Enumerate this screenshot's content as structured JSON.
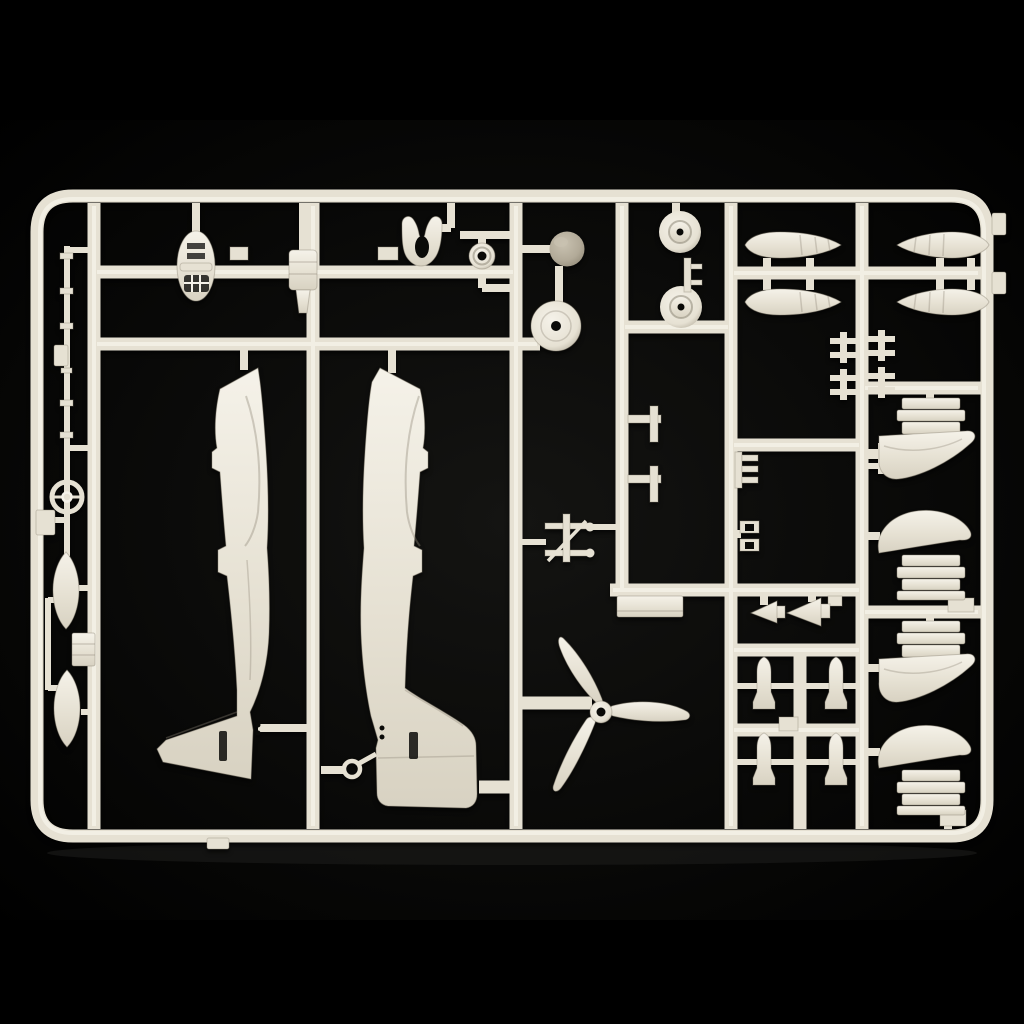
{
  "meta": {
    "type": "photograph",
    "subject": "plastic model aircraft kit sprue",
    "description": "Ivory injection-molded model kit parts tree (sprue) on a black background: two fuselage halves, three-blade propeller, four drop tank halves, wheels, spinner dome, engine cowling halves, small bombs, antenna mast and assorted small parts held in a rounded rectangular runner frame."
  },
  "scene": {
    "colors": {
      "background": "#000000",
      "vignette": "#141412",
      "plastic": "#e6e1d3",
      "plastic_light": "#f5f2e9",
      "plastic_mid": "#d8d2c2",
      "plastic_dark": "#b1aa99",
      "outline": "#8e8878",
      "spinner_light": "#c9c2b1",
      "spinner": "#b2aa98",
      "spinner_dark": "#8f8775",
      "hole": "#0a0a08",
      "shadow": "#1c1c1a"
    }
  },
  "parts": {
    "frame": "sprue outer frame",
    "runners": "runner grid",
    "antenna_mast": "antenna mast with ring sight",
    "left_edge_block": "small block on left frame edge",
    "small_bomb_upper": "small bomb half, upper left",
    "small_bomb_lower": "small bomb half, lower left",
    "left_block": "rectangular block part",
    "cowl_front": "cowling front piece with grille",
    "engine_block": "engine block part",
    "horseshoe": "horseshoe shaped part",
    "hub_ring": "ring hub part",
    "spinner_dome": "propeller spinner dome",
    "wheel_disc": "wheel disc",
    "fuselage_left": "left fuselage half",
    "fuselage_right": "right fuselage half",
    "tail_hook": "tail hook ring",
    "wheel_upper": "main wheel, upper",
    "wheel_lower": "main wheel, lower",
    "axle_part": "axle part between wheels",
    "drop_tank_1": "drop tank half, upper left",
    "drop_tank_2": "drop tank half, lower left",
    "drop_tank_3": "drop tank half, upper right",
    "drop_tank_4": "drop tank half, lower right",
    "strut_crosses": "small cross strut parts",
    "bracket_1": "L-bracket part, upper",
    "bracket_2": "L-bracket part, lower",
    "comb_part": "comb shaped part",
    "clamp_part": "double clamp part",
    "gun_part": "machine gun part",
    "flat_plate": "flat plate part",
    "propeller": "three-blade propeller",
    "dart_1": "wedge fairing part, small",
    "dart_2": "wedge fairing part, large",
    "bomb_grid": "four small bomb halves",
    "cowling_1": "engine cowling half 1",
    "cowling_2": "engine cowling half 2",
    "cowling_3": "engine cowling half 3",
    "cowling_4": "engine cowling half 4",
    "gate_tabs": "sprue gate tabs and blocks"
  }
}
